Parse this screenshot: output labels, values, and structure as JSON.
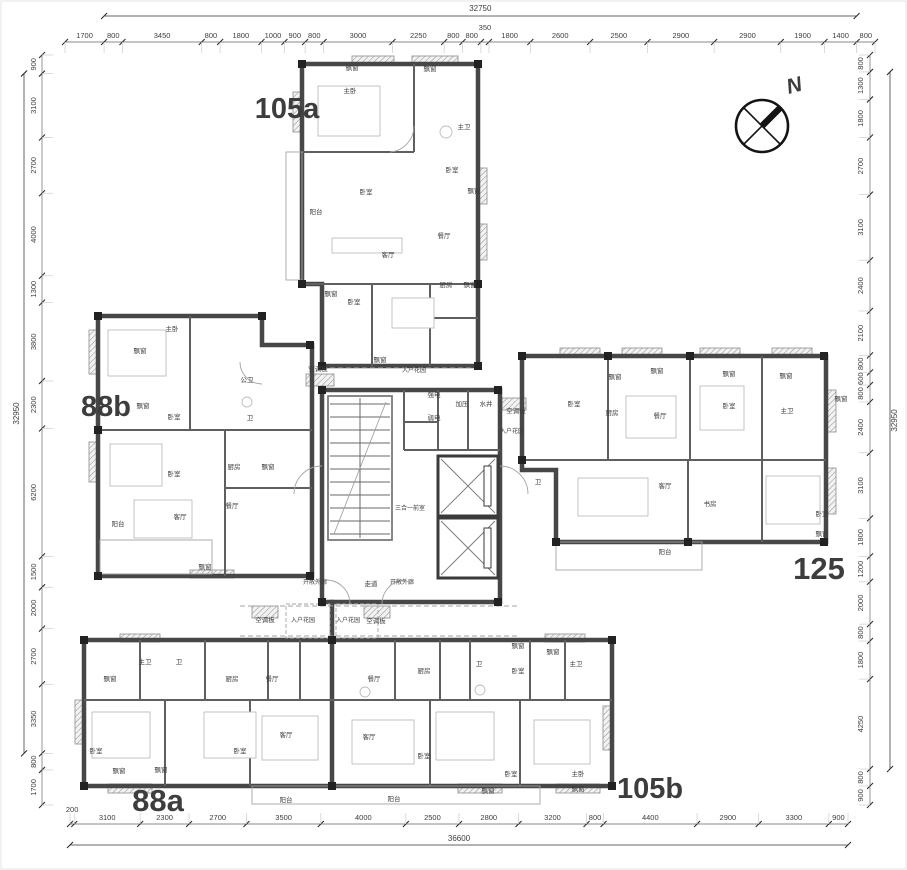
{
  "plan": {
    "north_label": "N",
    "core_label": "三合一前室",
    "unit_labels": [
      {
        "id": "105a",
        "text": "105a",
        "x": 287,
        "y": 118,
        "size": 29
      },
      {
        "id": "88b",
        "text": "88b",
        "x": 106,
        "y": 416,
        "size": 29
      },
      {
        "id": "125",
        "text": "125",
        "x": 819,
        "y": 579,
        "size": 31
      },
      {
        "id": "88a",
        "text": "88a",
        "x": 158,
        "y": 811,
        "size": 31
      },
      {
        "id": "105b",
        "text": "105b",
        "x": 650,
        "y": 798,
        "size": 29
      }
    ],
    "room_labels": [
      {
        "x": 352,
        "y": 70,
        "t": "飘窗"
      },
      {
        "x": 430,
        "y": 71,
        "t": "飘窗"
      },
      {
        "x": 350,
        "y": 93,
        "t": "主卧"
      },
      {
        "x": 464,
        "y": 129,
        "t": "主卫"
      },
      {
        "x": 452,
        "y": 172,
        "t": "卧室"
      },
      {
        "x": 474,
        "y": 193,
        "t": "飘窗"
      },
      {
        "x": 316,
        "y": 214,
        "t": "阳台"
      },
      {
        "x": 366,
        "y": 194,
        "t": "卧室"
      },
      {
        "x": 388,
        "y": 257,
        "t": "客厅"
      },
      {
        "x": 444,
        "y": 238,
        "t": "餐厅"
      },
      {
        "x": 446,
        "y": 287,
        "t": "厨房"
      },
      {
        "x": 331,
        "y": 296,
        "t": "飘窗"
      },
      {
        "x": 354,
        "y": 304,
        "t": "卧室"
      },
      {
        "x": 470,
        "y": 287,
        "t": "飘窗"
      },
      {
        "x": 380,
        "y": 362,
        "t": "飘窗"
      },
      {
        "x": 318,
        "y": 371,
        "t": "空调板"
      },
      {
        "x": 414,
        "y": 372,
        "t": "入户花园"
      },
      {
        "x": 434,
        "y": 397,
        "t": "强电"
      },
      {
        "x": 434,
        "y": 420,
        "t": "弱电"
      },
      {
        "x": 462,
        "y": 406,
        "t": "加压"
      },
      {
        "x": 486,
        "y": 406,
        "t": "水井"
      },
      {
        "x": 516,
        "y": 413,
        "t": "空调板"
      },
      {
        "x": 512,
        "y": 433,
        "t": "入户花园"
      },
      {
        "x": 410,
        "y": 510,
        "t": "三合一前室"
      },
      {
        "x": 315,
        "y": 584,
        "t": "开敞外廊"
      },
      {
        "x": 371,
        "y": 586,
        "t": "走道"
      },
      {
        "x": 402,
        "y": 584,
        "t": "开敞外廊"
      },
      {
        "x": 265,
        "y": 622,
        "t": "空调板"
      },
      {
        "x": 303,
        "y": 622,
        "t": "入户花园"
      },
      {
        "x": 348,
        "y": 622,
        "t": "入户花园"
      },
      {
        "x": 376,
        "y": 623,
        "t": "空调板"
      },
      {
        "x": 140,
        "y": 353,
        "t": "飘窗"
      },
      {
        "x": 172,
        "y": 331,
        "t": "主卧"
      },
      {
        "x": 143,
        "y": 408,
        "t": "飘窗"
      },
      {
        "x": 174,
        "y": 419,
        "t": "卧室"
      },
      {
        "x": 247,
        "y": 382,
        "t": "公卫"
      },
      {
        "x": 250,
        "y": 420,
        "t": "卫"
      },
      {
        "x": 234,
        "y": 469,
        "t": "厨房"
      },
      {
        "x": 268,
        "y": 469,
        "t": "飘窗"
      },
      {
        "x": 174,
        "y": 476,
        "t": "卧室"
      },
      {
        "x": 232,
        "y": 508,
        "t": "餐厅"
      },
      {
        "x": 180,
        "y": 519,
        "t": "客厅"
      },
      {
        "x": 118,
        "y": 526,
        "t": "阳台"
      },
      {
        "x": 205,
        "y": 569,
        "t": "飘窗"
      },
      {
        "x": 615,
        "y": 379,
        "t": "飘窗"
      },
      {
        "x": 657,
        "y": 373,
        "t": "飘窗"
      },
      {
        "x": 729,
        "y": 376,
        "t": "飘窗"
      },
      {
        "x": 786,
        "y": 378,
        "t": "飘窗"
      },
      {
        "x": 574,
        "y": 406,
        "t": "卧室"
      },
      {
        "x": 612,
        "y": 415,
        "t": "厨房"
      },
      {
        "x": 660,
        "y": 418,
        "t": "餐厅"
      },
      {
        "x": 729,
        "y": 408,
        "t": "卧室"
      },
      {
        "x": 787,
        "y": 413,
        "t": "主卫"
      },
      {
        "x": 841,
        "y": 401,
        "t": "飘窗"
      },
      {
        "x": 538,
        "y": 484,
        "t": "卫"
      },
      {
        "x": 665,
        "y": 488,
        "t": "客厅"
      },
      {
        "x": 710,
        "y": 506,
        "t": "书房"
      },
      {
        "x": 822,
        "y": 516,
        "t": "卧室"
      },
      {
        "x": 822,
        "y": 536,
        "t": "飘窗"
      },
      {
        "x": 665,
        "y": 554,
        "t": "阳台"
      },
      {
        "x": 145,
        "y": 664,
        "t": "主卫"
      },
      {
        "x": 179,
        "y": 664,
        "t": "卫"
      },
      {
        "x": 232,
        "y": 681,
        "t": "厨房"
      },
      {
        "x": 272,
        "y": 681,
        "t": "餐厅"
      },
      {
        "x": 110,
        "y": 681,
        "t": "飘窗"
      },
      {
        "x": 96,
        "y": 753,
        "t": "卧室"
      },
      {
        "x": 119,
        "y": 773,
        "t": "飘窗"
      },
      {
        "x": 161,
        "y": 772,
        "t": "飘窗"
      },
      {
        "x": 240,
        "y": 753,
        "t": "卧室"
      },
      {
        "x": 286,
        "y": 737,
        "t": "客厅"
      },
      {
        "x": 286,
        "y": 802,
        "t": "阳台"
      },
      {
        "x": 374,
        "y": 681,
        "t": "餐厅"
      },
      {
        "x": 424,
        "y": 673,
        "t": "厨房"
      },
      {
        "x": 479,
        "y": 666,
        "t": "卫"
      },
      {
        "x": 518,
        "y": 673,
        "t": "卧室"
      },
      {
        "x": 518,
        "y": 648,
        "t": "飘窗"
      },
      {
        "x": 553,
        "y": 654,
        "t": "飘窗"
      },
      {
        "x": 576,
        "y": 666,
        "t": "主卫"
      },
      {
        "x": 369,
        "y": 739,
        "t": "客厅"
      },
      {
        "x": 424,
        "y": 758,
        "t": "卧室"
      },
      {
        "x": 511,
        "y": 776,
        "t": "卧室"
      },
      {
        "x": 578,
        "y": 776,
        "t": "主卧"
      },
      {
        "x": 394,
        "y": 801,
        "t": "阳台"
      },
      {
        "x": 488,
        "y": 793,
        "t": "飘窗"
      },
      {
        "x": 578,
        "y": 791,
        "t": "飘窗"
      }
    ]
  },
  "dimensions": {
    "top": {
      "overall": 32750,
      "span": [
        1,
        20
      ],
      "segments": [
        1700,
        800,
        3450,
        800,
        1800,
        1000,
        900,
        800,
        3000,
        2250,
        800,
        800,
        350,
        1800,
        2600,
        2500,
        2900,
        2900,
        1900,
        1400,
        800
      ]
    },
    "bottom": {
      "overall": 36600,
      "span": [
        0,
        14
      ],
      "segments": [
        200,
        3100,
        2300,
        2700,
        3500,
        4000,
        2500,
        2800,
        3200,
        800,
        4400,
        2900,
        3300,
        900
      ]
    },
    "left": {
      "overall": 32950,
      "span": [
        1,
        12
      ],
      "segments": [
        900,
        3100,
        2700,
        4000,
        1300,
        3800,
        2300,
        6200,
        1500,
        2000,
        2700,
        3350,
        800,
        1700
      ]
    },
    "right": {
      "overall": 32950,
      "span": [
        1,
        18
      ],
      "segments": [
        800,
        1300,
        1800,
        2700,
        3100,
        2400,
        2100,
        800,
        600,
        800,
        2400,
        3100,
        1800,
        1200,
        2000,
        800,
        1800,
        4250,
        800,
        900
      ]
    }
  }
}
